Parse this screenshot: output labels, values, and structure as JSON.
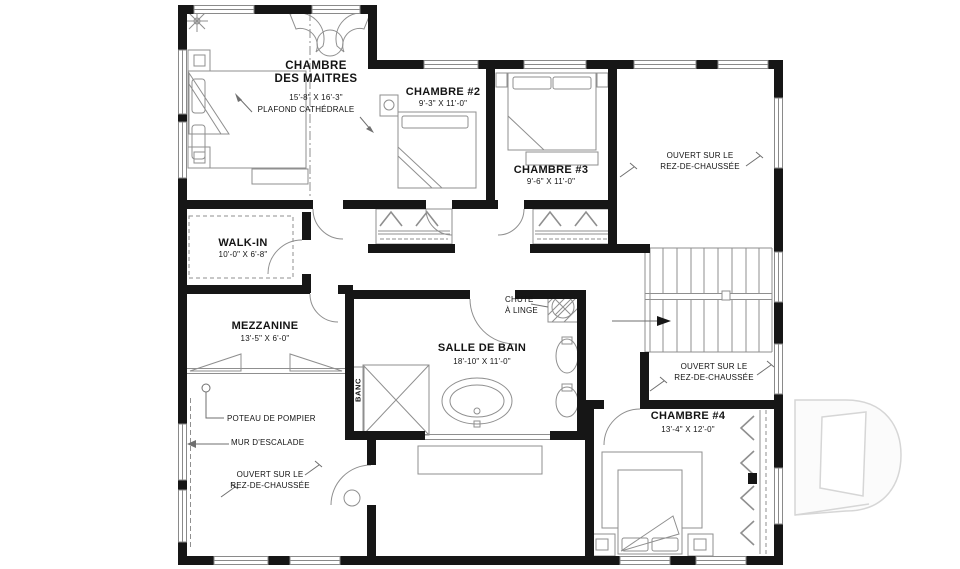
{
  "watermark": {
    "letter": "D"
  },
  "rooms": {
    "master": {
      "name": "CHAMBRE\nDES MAITRES",
      "dims": "15'-8\" X 16'-3\"",
      "note": "PLAFOND CATHÉDRALE"
    },
    "chambre2": {
      "name": "CHAMBRE #2",
      "dims": "9'-3\" X 11'-0\""
    },
    "chambre3": {
      "name": "CHAMBRE #3",
      "dims": "9'-6\" X 11'-0\""
    },
    "walkin": {
      "name": "WALK-IN",
      "dims": "10'-0\" X 6'-8\""
    },
    "mezzanine": {
      "name": "MEZZANINE",
      "dims": "13'-5\" X 6'-0\""
    },
    "bathroom": {
      "name": "SALLE DE BAIN",
      "dims": "18'-10\" X 11'-0\""
    },
    "chambre4": {
      "name": "CHAMBRE #4",
      "dims": "13'-4\" X 12'-0\""
    }
  },
  "open_areas": {
    "top_right": {
      "label": "OUVERT SUR LE\nREZ-DE-CHAUSSÉE"
    },
    "mid_right": {
      "label": "OUVERT SUR LE\nREZ-DE-CHAUSSÉE"
    },
    "bottom_left": {
      "label": "OUVERT SUR LE\nREZ-DE-CHAUSSÉE"
    }
  },
  "annotations": {
    "chute": {
      "label": "CHUTE\nÀ LINGE"
    },
    "poteau": {
      "label": "POTEAU DE POMPIER"
    },
    "mur": {
      "label": "MUR D'ESCALADE"
    },
    "banc": {
      "label": "BANC"
    }
  },
  "colors": {
    "wall": "#161616",
    "line": "#8f8f8f",
    "watermark": "#d6d6d6"
  }
}
